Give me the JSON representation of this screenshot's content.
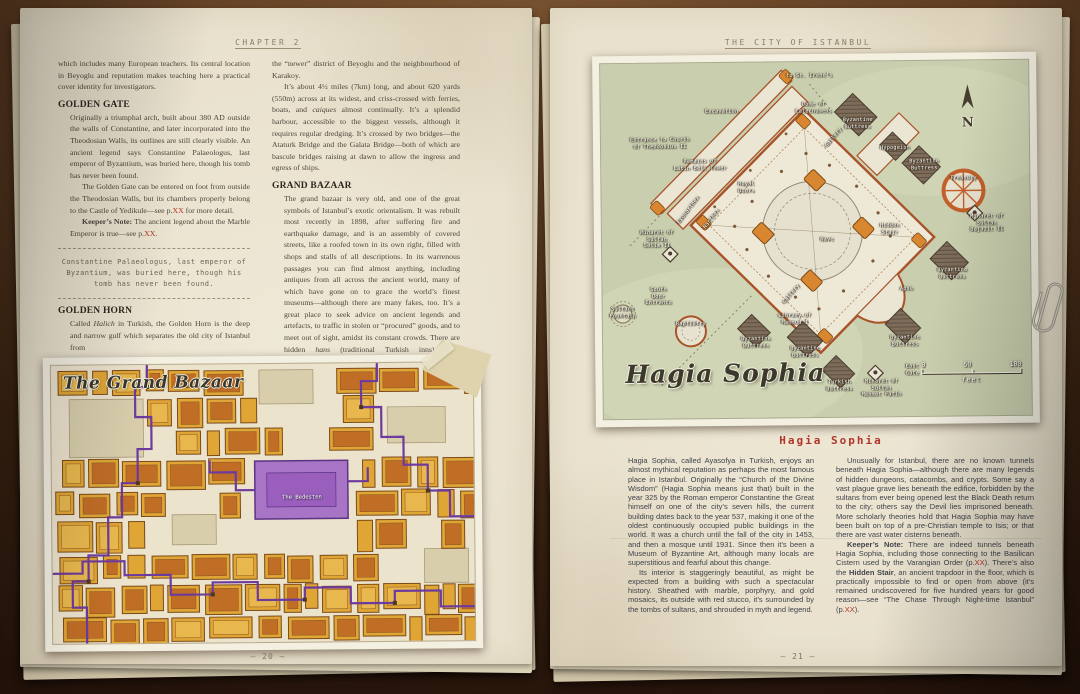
{
  "colors": {
    "accent_red": "#b03528",
    "bazaar_gold": "#dfa636",
    "bazaar_orange": "#c06d26",
    "route_purple": "#6d3a9e",
    "bedesten_purple": "#a874c6",
    "map_green": "#c9cfae",
    "wall_orange": "#a8532a"
  },
  "left_page": {
    "header": "CHAPTER 2",
    "page_number": "– 20 –",
    "col1": {
      "intro": "which includes many European teachers. Its central location in Beyoglu and reputation makes teaching here a practical cover identity for investigators.",
      "h1": "GOLDEN GATE",
      "p1": "Originally a triumphal arch, built about 380 AD outside the walls of Constantine, and later incorporated into the Theodosian Walls, its outlines are still clearly visible. An ancient legend says Constantine Palaeologus, last emperor of Byzantium, was buried here, though his tomb has never been found.",
      "p2a": "The Golden Gate can be entered on foot from outside the Theodosian Walls, but its chambers properly belong to the Castle of Yedikule—see p.",
      "p2_xx": "XX",
      "p2b": " for more detail.",
      "kn_label": "Keeper’s Note:",
      "kn_a": " The ancient legend about the Marble Emperor is true—see p.",
      "kn_xx": "XX",
      "kn_b": ".",
      "quote": "Constantine Palaeologus, last emperor of Byzantium, was buried here, though his tomb has never been found.",
      "h2": "GOLDEN HORN",
      "p3a": "Called ",
      "p3_it": "Halich",
      "p3b": " in Turkish, the Golden Horn is the deep and narrow gulf which separates the old city of Istanbul from"
    },
    "col2": {
      "p1": "the “newer” district of Beyoglu and the neighbourhood of Karakoy.",
      "p2a": "It’s about 4½ miles (7km) long, and about 620 yards (550m) across at its widest, and criss-crossed with ferries, boats, and ",
      "p2_it": "caiques",
      "p2b": " almost continually. It’s a splendid harbour, accessible to the biggest vessels, although it requires regular dredging. It’s crossed by two bridges—the Ataturk Bridge and the Galata Bridge—both of which are bascule bridges raising at dawn to allow the ingress and egress of ships.",
      "h1": "GRAND BAZAAR",
      "p3a": "The grand bazaar is very old, and one of the great symbols of Istanbul’s exotic orientalism. It was rebuilt most recently in 1898, after suffering fire and earthquake damage, and is an assembly of covered streets, like a roofed town in its own right, filled with shops and stalls of all descriptions. In its warrenous passages you can find almost anything, including antiques from all across the ancient world, many of which have gone on to grace the world’s finest museums—although there are many fakes, too. It’s a great place to seek advice on ancient legends and artefacts, to traffic in stolen or “procured” goods, and to meet out of sight, amidst its constant crowds. There are hidden ",
      "p3_it": "hans",
      "p3b": " (traditional Turkish inns) here, hemispherical domes, grated gates, and tiny high windows allowing shafts of dusty light to filter into the shrouded interior.",
      "p4a": "Wali Hasan Ali Yilmaz, mystic leader of the Servants of Mehmet (p.",
      "p4_xx": "XX",
      "p4b": "), sometimes works here incognito in a"
    },
    "map": {
      "title": "The Grand Bazaar",
      "highlight_label": "The Bedesten"
    }
  },
  "right_page": {
    "header": "THE CITY OF ISTANBUL",
    "page_number": "– 21 –",
    "map": {
      "title": "Hagia Sophia",
      "compass": "N",
      "scale": {
        "t0": "0",
        "t50": "50",
        "t100": "100",
        "unit": "feet"
      },
      "labels": [
        {
          "text": "to St. Irene’s",
          "x": 209,
          "y": 14
        },
        {
          "text": "Excavation",
          "x": 121,
          "y": 49
        },
        {
          "text": "Dome of\nCatechumens",
          "x": 213,
          "y": 46
        },
        {
          "text": "Byzantine\nButtress",
          "x": 257,
          "y": 62
        },
        {
          "text": "Hypogeion",
          "x": 294,
          "y": 87
        },
        {
          "text": "Byzantine\nButtress",
          "x": 323,
          "y": 104
        },
        {
          "text": "Treasury",
          "x": 362,
          "y": 118
        },
        {
          "text": "Entrance to Church\nof Theodosius II",
          "x": 59,
          "y": 80
        },
        {
          "text": "Remains of\nLatin Bell Tower",
          "x": 99,
          "y": 102
        },
        {
          "text": "Royal\nDoors",
          "x": 145,
          "y": 125
        },
        {
          "text": "Exonarthex",
          "x": 87,
          "y": 147,
          "rot": -52
        },
        {
          "text": "Narthex",
          "x": 110,
          "y": 156,
          "rot": -52
        },
        {
          "text": "Gallery",
          "x": 233,
          "y": 76,
          "rot": -50
        },
        {
          "text": "Nave",
          "x": 225,
          "y": 178
        },
        {
          "text": "Hidden\nStair",
          "x": 288,
          "y": 168
        },
        {
          "text": "Minaret of\nSultan\nBejazit II",
          "x": 385,
          "y": 163
        },
        {
          "text": "Byzantine\nButtress",
          "x": 350,
          "y": 213
        },
        {
          "text": "Apse",
          "x": 304,
          "y": 228
        },
        {
          "text": "Gallery",
          "x": 189,
          "y": 232,
          "rot": -50
        },
        {
          "text": "Minaret of\nSultan\nSelim II",
          "x": 55,
          "y": 176
        },
        {
          "text": "South\nDoor\nEntrance",
          "x": 56,
          "y": 233
        },
        {
          "text": "Sultans\nFountain",
          "x": 20,
          "y": 249
        },
        {
          "text": "Baptistry",
          "x": 88,
          "y": 261
        },
        {
          "text": "Library of\nMahmud I",
          "x": 192,
          "y": 257
        },
        {
          "text": "Byzantine\nButtress",
          "x": 153,
          "y": 280
        },
        {
          "text": "Byzantine\nButtress",
          "x": 202,
          "y": 290
        },
        {
          "text": "Byzantine\nButtress",
          "x": 302,
          "y": 280
        },
        {
          "text": "East\nGate",
          "x": 309,
          "y": 309
        },
        {
          "text": "Turkish\nButtress",
          "x": 236,
          "y": 324
        },
        {
          "text": "Minaret of\nSultan\nMehmet Fatih",
          "x": 278,
          "y": 327
        }
      ]
    },
    "section": {
      "heading": "Hagia Sophia",
      "a_p1": "Hagia Sophia, called Ayasofya in Turkish, enjoys an almost mythical reputation as perhaps the most famous place in Istanbul. Originally the “Church of the Divine Wisdom” (Hagia Sophia means just that) built in the year 325 by the Roman emperor Constantine the Great himself on one of the city’s seven hills, the current building dates back to the year 537, making it one of the oldest continuously occupied public buildings in the world. It was a church until the fall of the city in 1453, and then a mosque until 1931. Since then it’s been a Museum of Byzantine Art, although many locals are superstitious and fearful about this change.",
      "a_p2": "Its interior is staggeringly beautiful, as might be expected from a building with such a spectacular history. Sheathed with marble, porphyry, and gold mosaics, its outside with red stucco, it’s surrounded by the tombs of sultans, and shrouded in myth and legend.",
      "b_p1": "Unusually for Istanbul, there are no known tunnels beneath Hagia Sophia—although there are many legends of hidden dungeons, catacombs, and crypts. Some say a vast plague grave lies beneath the edifice, forbidden by the sultans from ever being opened lest the Black Death return to the city; others say the Devil lies imprisoned beneath. More scholarly theories hold that Hagia Sophia may have been built on top of a pre-Christian temple to Isis; or that there are vast water cisterns beneath.",
      "kn_label": "Keeper’s Note:",
      "kn_a": " There are indeed tunnels beneath Hagia Sophia, including those connecting to the Basilican Cistern used by the Varangian Order (p.",
      "kn_xx1": "XX",
      "kn_b": "). There’s also the ",
      "kn_bold": "Hidden Stair",
      "kn_c": ", an ancient trapdoor in the floor, which is practically impossible to find or open from above (it’s remained undiscovered for five hundred years for good reason—see “The Chase Through Night-time Istanbul” (p.",
      "kn_xx2": "XX",
      "kn_d": ")."
    }
  }
}
